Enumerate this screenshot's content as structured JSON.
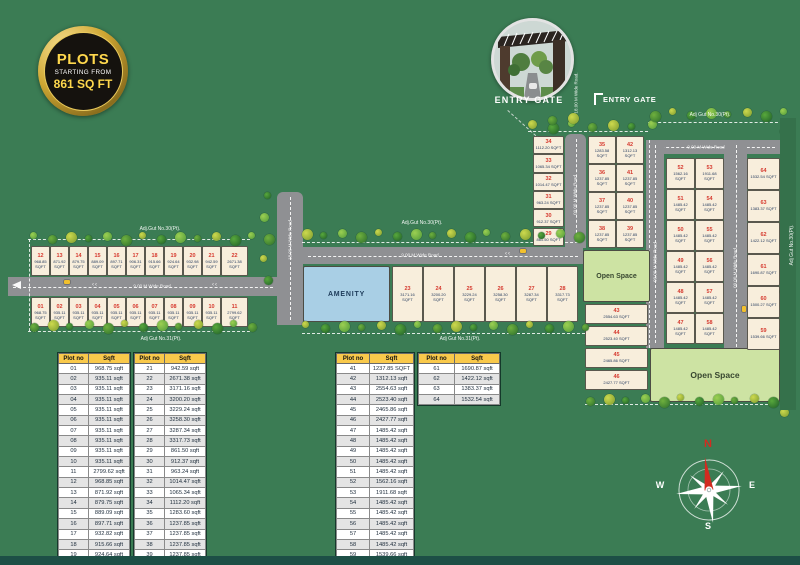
{
  "badge": {
    "line1": "PLOTS",
    "line2": "STARTING FROM",
    "line3": "861 SQ FT"
  },
  "entry_gate": {
    "caption": "ENTRY GATE",
    "marker": "ENTRY GATE"
  },
  "compass": {
    "n": "N",
    "e": "E",
    "s": "S",
    "w": "W"
  },
  "areas": {
    "amenity": "AMENITY",
    "open_space_top": "Open Space",
    "open_space_bottom": "Open Space"
  },
  "boundary_labels": {
    "top_left": "Adj.Gut No.30(Pt).",
    "bottom_left": "Adj Gut No.31(Pt).",
    "top_mid": "Adj.Gut No.30(Pt).",
    "bottom_mid": "Adj Gut No.31(Pt).",
    "top_right": "Adj Gut No.30(Pt).",
    "right_strip": "Adj Gut No.30(Pt)."
  },
  "road_labels": {
    "left": "9.00 M Wide Road",
    "center": "9.00 M Wide Road",
    "center_stub": "18.00 M Wide Road",
    "entry": "18.00 M Wide Road.",
    "mid_vertical": "09.00 M Wide Road",
    "right_top": "9.00 M Wide Road",
    "right_left": "09.00 M Wide Road",
    "right_mid": "09.00 M Wide Road"
  },
  "map_plots": [
    {
      "no": "01",
      "sqft": "968.75 SQFT"
    },
    {
      "no": "02",
      "sqft": "935.11 SQFT"
    },
    {
      "no": "03",
      "sqft": "935.11 SQFT"
    },
    {
      "no": "04",
      "sqft": "935.11 SQFT"
    },
    {
      "no": "05",
      "sqft": "935.11 SQFT"
    },
    {
      "no": "06",
      "sqft": "935.11 SQFT"
    },
    {
      "no": "07",
      "sqft": "935.11 SQFT"
    },
    {
      "no": "08",
      "sqft": "935.11 SQFT"
    },
    {
      "no": "09",
      "sqft": "935.11 SQFT"
    },
    {
      "no": "10",
      "sqft": "935.11 SQFT"
    },
    {
      "no": "11",
      "sqft": "2799.62 SQFT"
    },
    {
      "no": "12",
      "sqft": "968.85 SQFT"
    },
    {
      "no": "13",
      "sqft": "871.92 SQFT"
    },
    {
      "no": "14",
      "sqft": "879.75 SQFT"
    },
    {
      "no": "15",
      "sqft": "889.09 SQFT"
    },
    {
      "no": "16",
      "sqft": "897.71 SQFT"
    },
    {
      "no": "17",
      "sqft": "906.31 SQFT"
    },
    {
      "no": "18",
      "sqft": "915.66 SQFT"
    },
    {
      "no": "19",
      "sqft": "924.64 SQFT"
    },
    {
      "no": "20",
      "sqft": "932.98 SQFT"
    },
    {
      "no": "21",
      "sqft": "942.59 SQFT"
    },
    {
      "no": "22",
      "sqft": "2671.38 SQFT"
    },
    {
      "no": "23",
      "sqft": "3171.16 SQFT"
    },
    {
      "no": "24",
      "sqft": "3200.20 SQFT"
    },
    {
      "no": "25",
      "sqft": "3229.24 SQFT"
    },
    {
      "no": "26",
      "sqft": "3258.30 SQFT"
    },
    {
      "no": "27",
      "sqft": "3287.34 SQFT"
    },
    {
      "no": "28",
      "sqft": "3317.73 SQFT"
    },
    {
      "no": "29",
      "sqft": "861.50 SQFT"
    },
    {
      "no": "30",
      "sqft": "912.37 SQFT"
    },
    {
      "no": "31",
      "sqft": "963.24 SQFT"
    },
    {
      "no": "32",
      "sqft": "1014.47 SQFT"
    },
    {
      "no": "33",
      "sqft": "1065.34 SQFT"
    },
    {
      "no": "34",
      "sqft": "1112.20 SQFT"
    },
    {
      "no": "35",
      "sqft": "1283.58 SQFT"
    },
    {
      "no": "36",
      "sqft": "1237.85 SQFT"
    },
    {
      "no": "37",
      "sqft": "1237.85 SQFT"
    },
    {
      "no": "38",
      "sqft": "1237.85 SQFT"
    },
    {
      "no": "39",
      "sqft": "1237.85 SQFT"
    },
    {
      "no": "40",
      "sqft": "1237.85 SQFT"
    },
    {
      "no": "41",
      "sqft": "1237.85 SQFT"
    },
    {
      "no": "42",
      "sqft": "1312.13 SQFT"
    },
    {
      "no": "43",
      "sqft": "2554.63 SQFT"
    },
    {
      "no": "44",
      "sqft": "2523.40 SQFT"
    },
    {
      "no": "45",
      "sqft": "2465.86 SQFT"
    },
    {
      "no": "46",
      "sqft": "2427.77 SQFT"
    },
    {
      "no": "47",
      "sqft": "1485.42 SQFT"
    },
    {
      "no": "48",
      "sqft": "1485.42 SQFT"
    },
    {
      "no": "49",
      "sqft": "1485.42 SQFT"
    },
    {
      "no": "50",
      "sqft": "1485.42 SQFT"
    },
    {
      "no": "51",
      "sqft": "1485.42 SQFT"
    },
    {
      "no": "52",
      "sqft": "1562.16 SQFT"
    },
    {
      "no": "53",
      "sqft": "1911.68 SQFT"
    },
    {
      "no": "54",
      "sqft": "1485.42 SQFT"
    },
    {
      "no": "55",
      "sqft": "1485.42 SQFT"
    },
    {
      "no": "56",
      "sqft": "1485.42 SQFT"
    },
    {
      "no": "57",
      "sqft": "1485.42 SQFT"
    },
    {
      "no": "58",
      "sqft": "1485.42 SQFT"
    },
    {
      "no": "59",
      "sqft": "1539.66 SQFT"
    },
    {
      "no": "60",
      "sqft": "1500.27 SQFT"
    },
    {
      "no": "61",
      "sqft": "1690.87 SQFT"
    },
    {
      "no": "62",
      "sqft": "1422.12 SQFT"
    },
    {
      "no": "63",
      "sqft": "1383.37 SQFT"
    },
    {
      "no": "64",
      "sqft": "1532.54 SQFT"
    }
  ],
  "tables": [
    {
      "headers": [
        "Plot no",
        "Sqft"
      ],
      "rows": [
        [
          "01",
          "968.75 sqft"
        ],
        [
          "02",
          "935.11 sqft"
        ],
        [
          "03",
          "935.11 sqft"
        ],
        [
          "04",
          "935.11 sqft"
        ],
        [
          "05",
          "935.11 sqft"
        ],
        [
          "06",
          "935.11 sqft"
        ],
        [
          "07",
          "935.11 sqft"
        ],
        [
          "08",
          "935.11 sqft"
        ],
        [
          "09",
          "935.11 sqft"
        ],
        [
          "10",
          "935.11 sqft"
        ],
        [
          "11",
          "2799.62 sqft"
        ],
        [
          "12",
          "968.85 sqft"
        ],
        [
          "13",
          "871.92 sqft"
        ],
        [
          "14",
          "879.75 sqft"
        ],
        [
          "15",
          "889.09 sqft"
        ],
        [
          "16",
          "897.71 sqft"
        ],
        [
          "17",
          "932.82 sqft"
        ],
        [
          "18",
          "915.66 sqft"
        ],
        [
          "19",
          "924.64 sqft"
        ],
        [
          "20",
          "933.98 sqft"
        ]
      ]
    },
    {
      "headers": [
        "Plot no",
        "Sqft"
      ],
      "rows": [
        [
          "21",
          "942.59 sqft"
        ],
        [
          "22",
          "2671.38 sqft"
        ],
        [
          "23",
          "3171.16 sqft"
        ],
        [
          "24",
          "3200.20 sqft"
        ],
        [
          "25",
          "3229.24 sqft"
        ],
        [
          "26",
          "3258.30 sqft"
        ],
        [
          "27",
          "3287.34 sqft"
        ],
        [
          "28",
          "3317.73 sqft"
        ],
        [
          "29",
          "861.50 sqft"
        ],
        [
          "30",
          "912.37 sqft"
        ],
        [
          "31",
          "963.24 sqft"
        ],
        [
          "32",
          "1014.47 sqft"
        ],
        [
          "33",
          "1065.34 sqft"
        ],
        [
          "34",
          "1112.20 sqft"
        ],
        [
          "35",
          "1283.60 sqft"
        ],
        [
          "36",
          "1237.85 sqft"
        ],
        [
          "37",
          "1237.85 sqft"
        ],
        [
          "38",
          "1237.85 sqft"
        ],
        [
          "39",
          "1237.85 sqft"
        ],
        [
          "40",
          "1237.85 sqft"
        ]
      ]
    },
    {
      "headers": [
        "Plot no",
        "Sqft"
      ],
      "rows": [
        [
          "41",
          "1237.85 SQFT"
        ],
        [
          "42",
          "1312.13 sqft"
        ],
        [
          "43",
          "2554.63 sqft"
        ],
        [
          "44",
          "2523.40 sqft"
        ],
        [
          "45",
          "2465.86 sqft"
        ],
        [
          "46",
          "2427.77 sqft"
        ],
        [
          "47",
          "1485.42 sqft"
        ],
        [
          "48",
          "1485.42 sqft"
        ],
        [
          "49",
          "1485.42 sqft"
        ],
        [
          "50",
          "1485.42 sqft"
        ],
        [
          "51",
          "1485.42 sqft"
        ],
        [
          "52",
          "1562.16 sqft"
        ],
        [
          "53",
          "1911.68 sqft"
        ],
        [
          "54",
          "1485.42 sqft"
        ],
        [
          "55",
          "1485.42 sqft"
        ],
        [
          "56",
          "1485.42 sqft"
        ],
        [
          "57",
          "1485.42 sqft"
        ],
        [
          "58",
          "1485.42 sqft"
        ],
        [
          "59",
          "1539.66 sqft"
        ],
        [
          "60",
          "1500.27 sqft"
        ]
      ]
    },
    {
      "headers": [
        "Plot no",
        "Sqft"
      ],
      "rows": [
        [
          "61",
          "1690.87 sqft"
        ],
        [
          "62",
          "1422.12 sqft"
        ],
        [
          "63",
          "1383.37 sqft"
        ],
        [
          "64",
          "1532.54 sqft"
        ]
      ]
    }
  ],
  "colors": {
    "background": "#3B7C54",
    "plot_fill": "#F8EEDC",
    "plot_number": "#D63A2F",
    "road": "#8F9093",
    "amenity_fill": "#A9CFE5",
    "open_space_fill": "#CDE3A3",
    "table_header": "#F9C94B",
    "badge_gold": "#D8A93A",
    "badge_text": "#FFD84D",
    "compass_north": "#D22B20",
    "footer_bar": "#1D4F46"
  }
}
